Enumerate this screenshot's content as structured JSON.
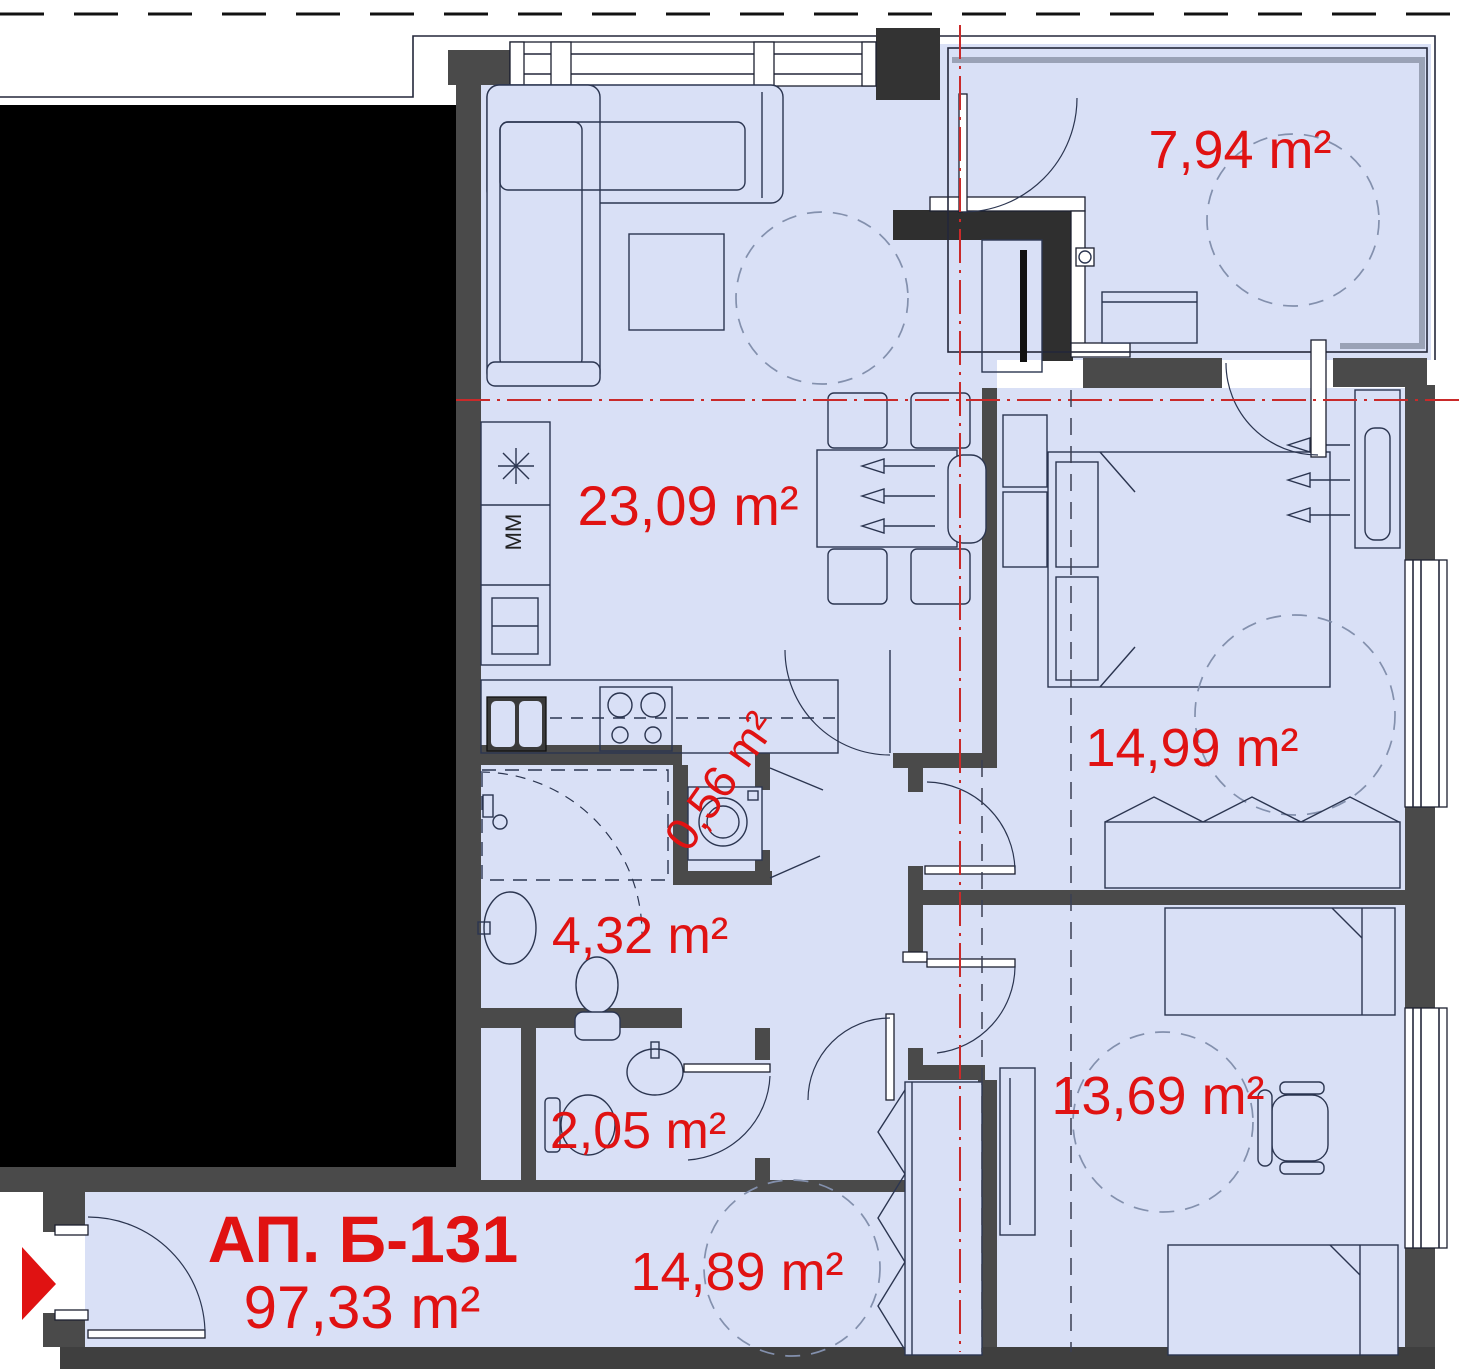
{
  "plan": {
    "apartment": {
      "id_label": "АП. Б-131",
      "total_area_label": "97,33 m²"
    },
    "rooms": [
      {
        "key": "terrace",
        "area_label": "7,94 m²"
      },
      {
        "key": "living_kitchen",
        "area_label": "23,09 m²"
      },
      {
        "key": "bedroom_1",
        "area_label": "14,99 m²"
      },
      {
        "key": "storage",
        "area_label": "0,56 m²"
      },
      {
        "key": "bathroom",
        "area_label": "4,32 m²"
      },
      {
        "key": "wc",
        "area_label": "2,05 m²"
      },
      {
        "key": "bedroom_2",
        "area_label": "13,69 m²"
      },
      {
        "key": "hallway",
        "area_label": "14,89 m²"
      }
    ],
    "kitchen": {
      "appliance_label": "MM"
    },
    "colors": {
      "label_red": "#e01212",
      "floor": "#d9e0f6",
      "wall": "#4a4a4a",
      "wall_dark": "#2f2f2f",
      "black_area": "#000000",
      "centerline_red": "#c92a2a",
      "rail_gray": "#9aa2b6",
      "entry_marker": "#e01212"
    }
  }
}
